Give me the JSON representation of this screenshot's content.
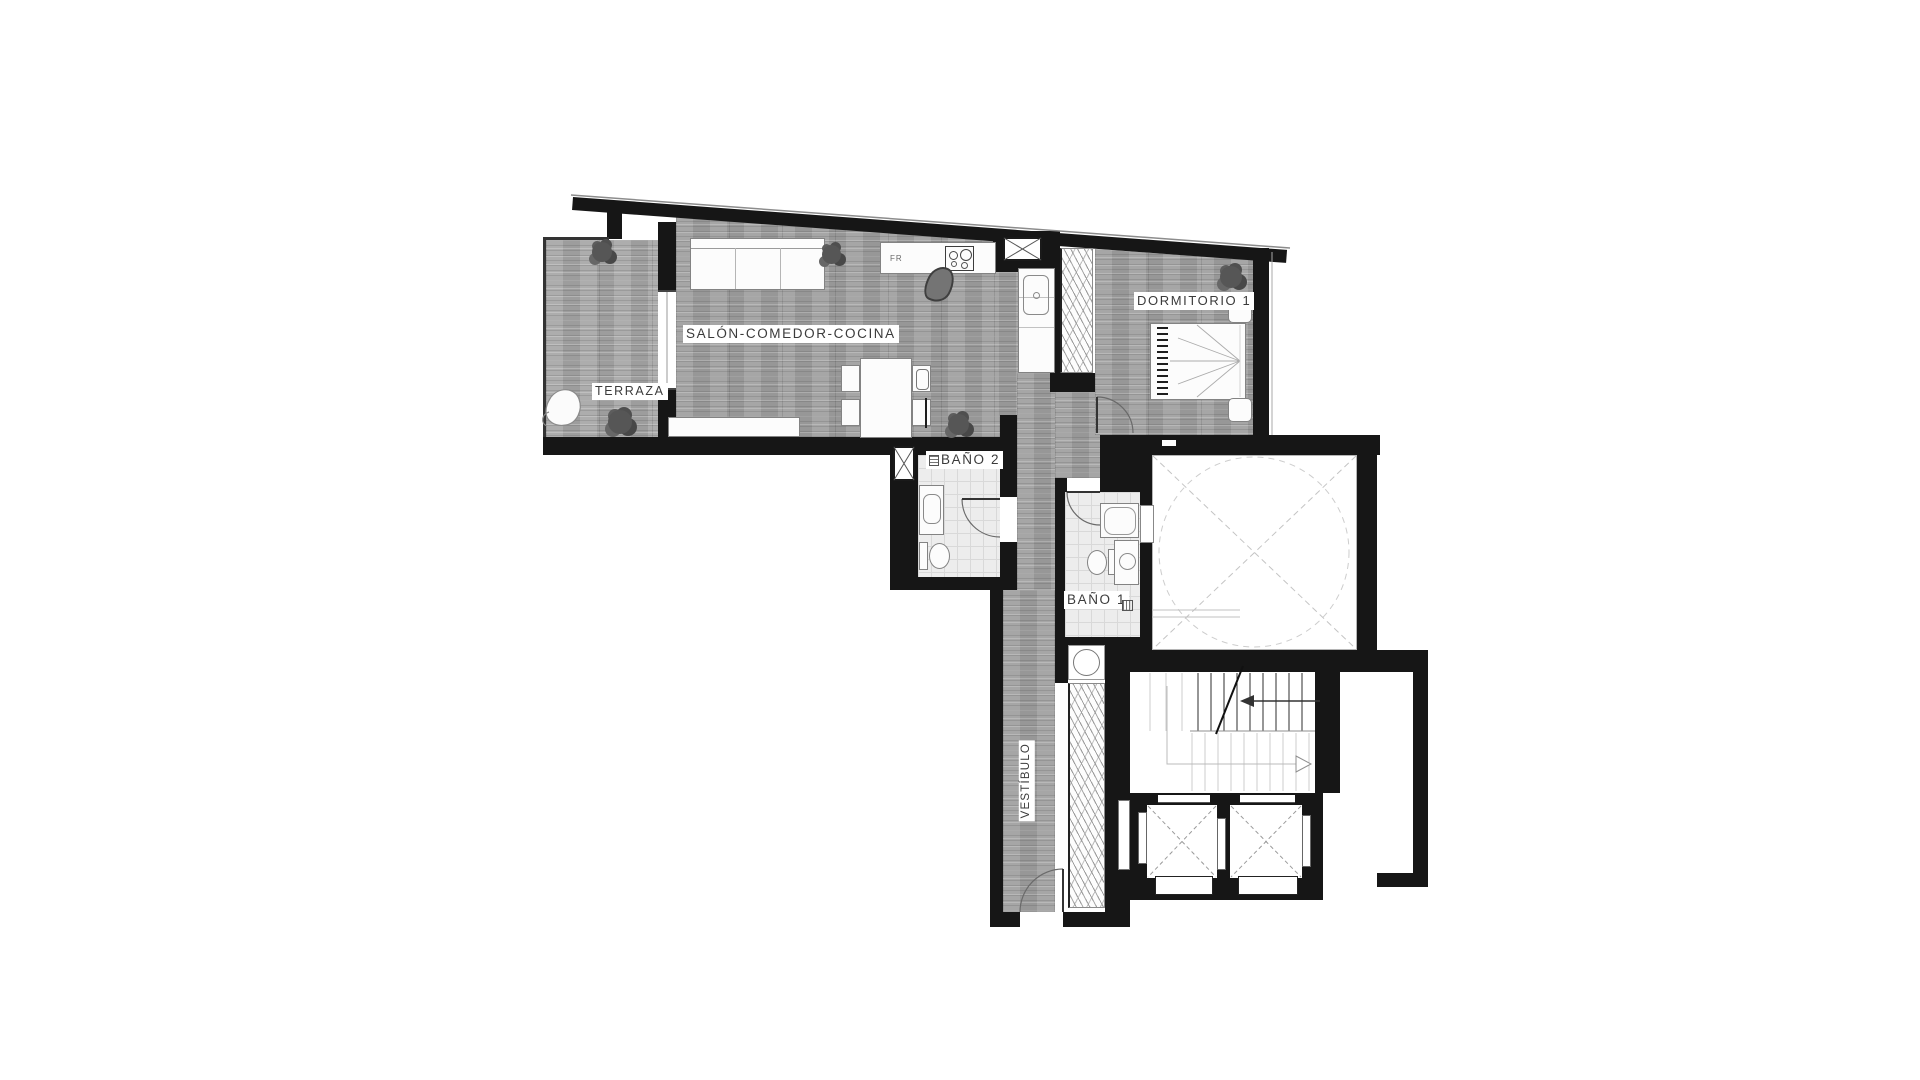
{
  "plan": {
    "type": "apartment-floor-plan",
    "rooms": {
      "terraza": {
        "label": "TERRAZA"
      },
      "salon": {
        "label": "SALÓN-COMEDOR-COCINA"
      },
      "dormitorio1": {
        "label": "DORMITORIO 1"
      },
      "bano2": {
        "label": "BAÑO 2"
      },
      "bano1": {
        "label": "BAÑO 1"
      },
      "vestibulo": {
        "label": "VESTÍBULO"
      }
    },
    "annotations": {
      "fridge": "FR"
    },
    "colors": {
      "wall": "#161616",
      "wood_floor": "#9f9f9f",
      "tile_floor": "#ededed",
      "label_text": "#3b3b3b",
      "background": "#ffffff"
    }
  }
}
